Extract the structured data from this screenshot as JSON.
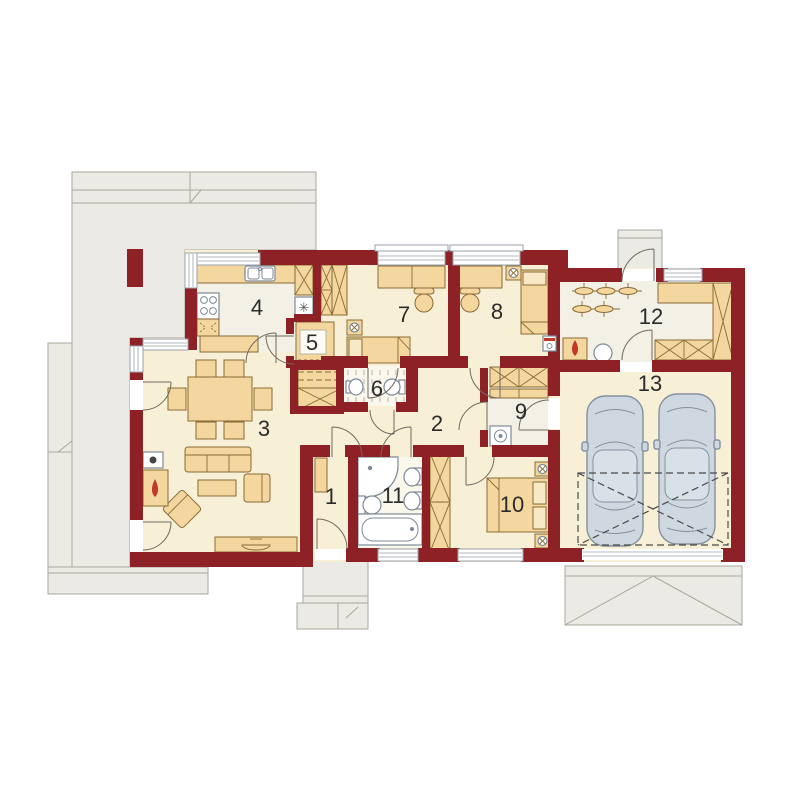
{
  "floor_plan": {
    "type": "house-floor-plan",
    "rooms": [
      {
        "number": "1"
      },
      {
        "number": "2"
      },
      {
        "number": "3"
      },
      {
        "number": "4"
      },
      {
        "number": "5"
      },
      {
        "number": "6"
      },
      {
        "number": "7"
      },
      {
        "number": "8"
      },
      {
        "number": "9"
      },
      {
        "number": "10"
      },
      {
        "number": "11"
      },
      {
        "number": "12"
      },
      {
        "number": "13"
      }
    ],
    "icons": {
      "fridge_icon": "✳"
    },
    "colors": {
      "wall": "#8e2126",
      "floor": "#f8f0d6",
      "floor_pale": "#f3f0e6",
      "furniture": "#f3d79e",
      "furniture_outline": "#8a6b34",
      "terrace": "#eceae4",
      "terrace_border": "#a9a79e",
      "car_body": "#cfd8e0",
      "car_outline": "#8391a0",
      "fixture_outline": "#7d8a96",
      "flame": "#c0392b",
      "label_text": "#2b2b2b"
    }
  }
}
